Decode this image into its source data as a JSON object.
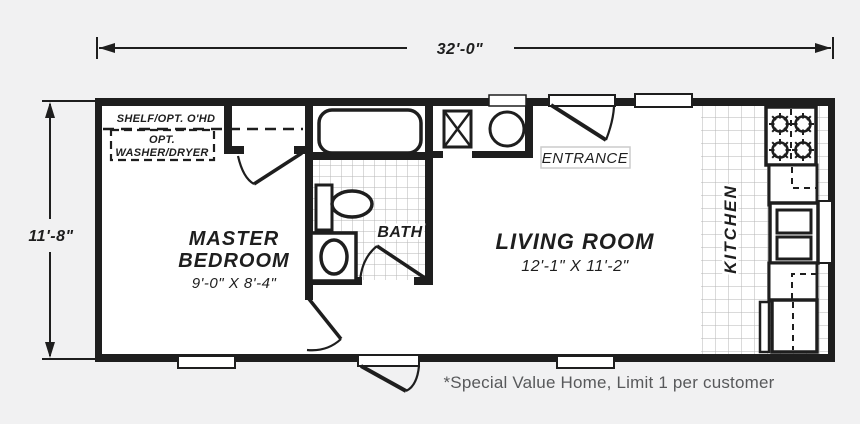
{
  "dimensions": {
    "width": "32'-0\"",
    "height": "11'-8\""
  },
  "rooms": {
    "master_bedroom": {
      "line1": "MASTER",
      "line2": "BEDROOM",
      "size": "9'-0\" X 8'-4\""
    },
    "bath": {
      "name": "BATH"
    },
    "living_room": {
      "name": "LIVING ROOM",
      "size": "12'-1\" X 11'-2\""
    },
    "kitchen": {
      "name": "KITCHEN"
    }
  },
  "labels": {
    "shelf": "SHELF/OPT. O'HD",
    "washer_opt_line1": "OPT.",
    "washer_opt_line2": "WASHER/DRYER",
    "entrance": "ENTRANCE"
  },
  "footnote": "*Special Value Home, Limit 1 per customer",
  "colors": {
    "wall": "#1e1e1e",
    "floor": "#ffffff",
    "background": "#f1f1f2",
    "tile_line": "#b5b5b5",
    "footnote_text": "#58595b"
  }
}
